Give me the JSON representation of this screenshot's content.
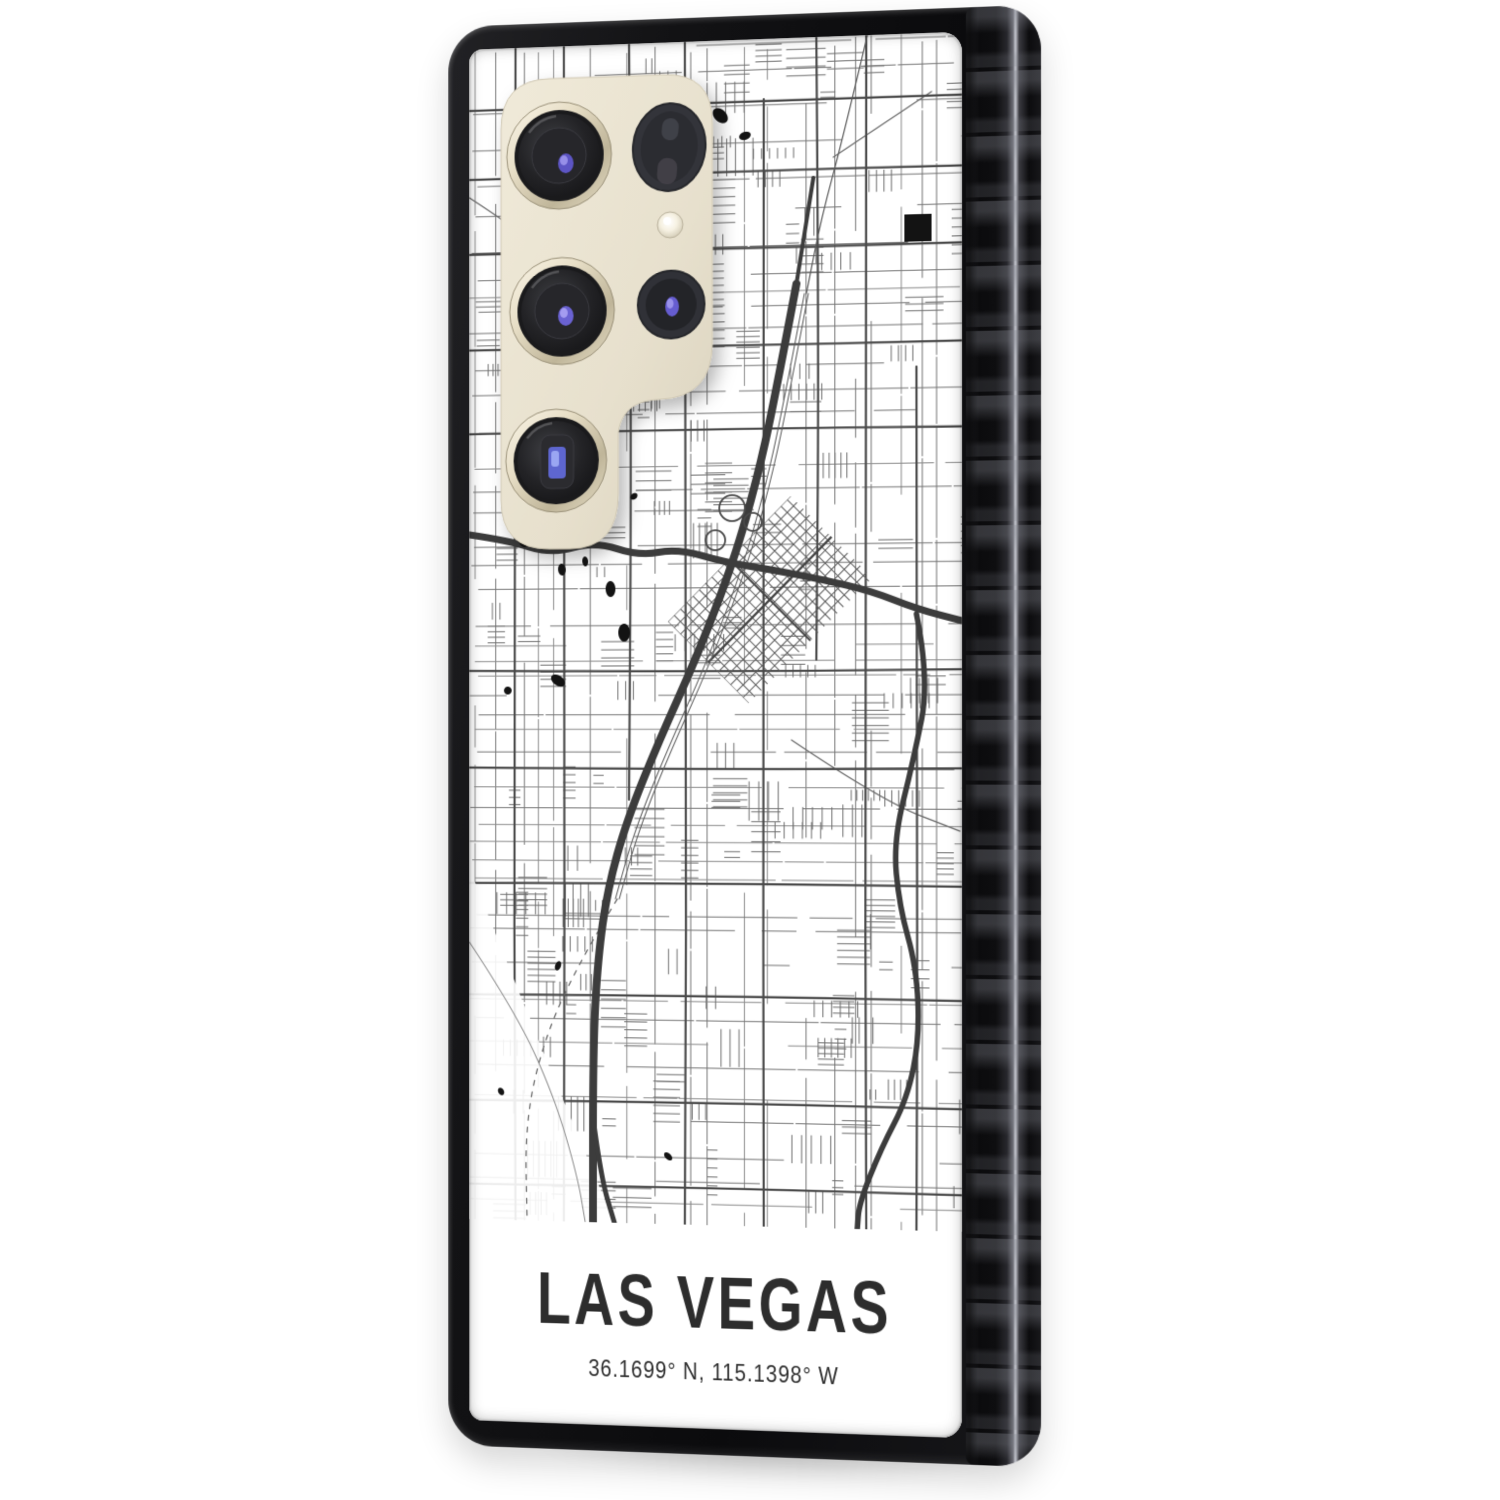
{
  "label": {
    "title": "LAS VEGAS",
    "subtitle": "36.1699° N, 115.1398° W",
    "text_color": "#2d2d2d"
  },
  "map": {
    "city": "Las Vegas",
    "background": "#ffffff",
    "street_color": "#757575",
    "detail_color": "#6e6e6e",
    "arterial_color": "#4a4a4a",
    "highway_color": "#3c3c3c",
    "rail_color": "#5a5a5a",
    "landmark_color": "#131313",
    "seed": 1337
  },
  "case": {
    "frame_color": "#121214",
    "side_color": "#0c0c0e",
    "print_background": "#ffffff"
  },
  "camera": {
    "plate_color": "#e9e2d0",
    "ring_color": "#d9d0b6",
    "lens_color": "#1c1c1e",
    "glint_color": "#6a62d2",
    "flash_color": "#f7f2e3"
  }
}
